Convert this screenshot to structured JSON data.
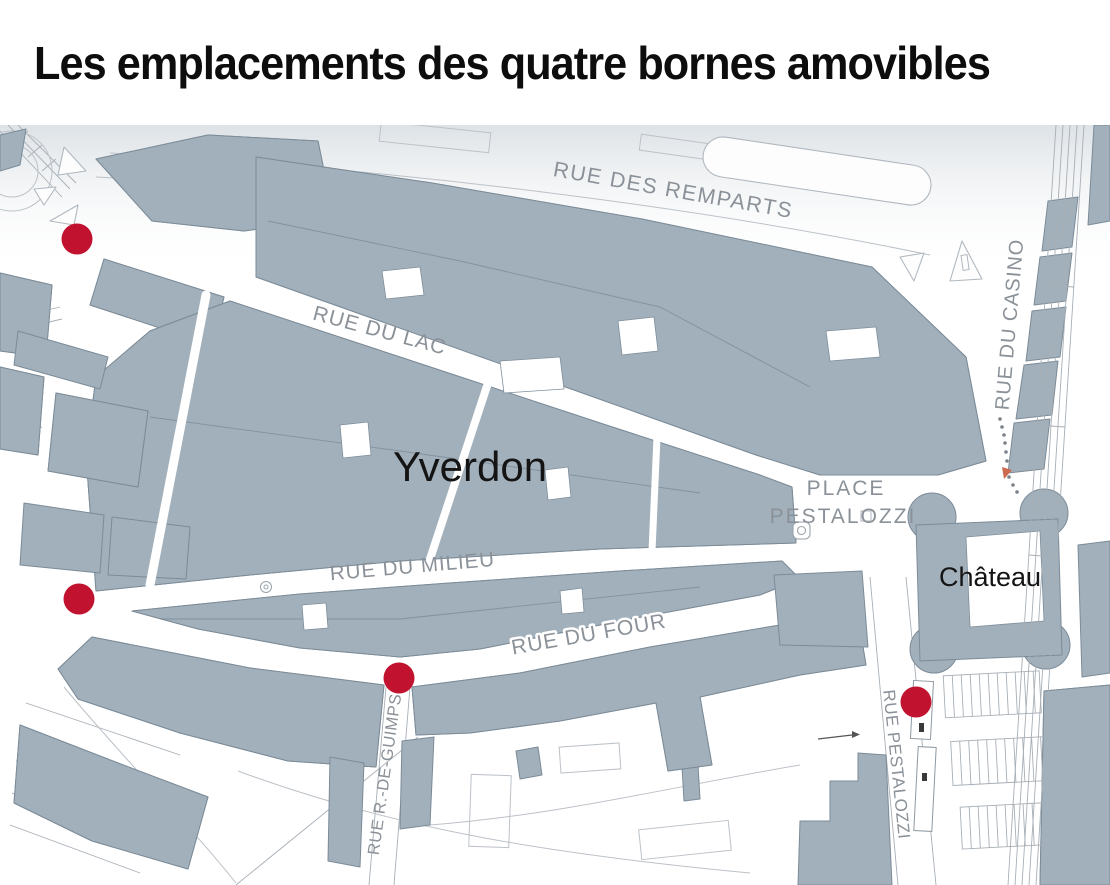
{
  "title": "Les emplacements des quatre bornes amovibles",
  "map": {
    "city": "Yverdon",
    "streets": {
      "remparts": "RUE DES REMPARTS",
      "lac": "RUE DU LAC",
      "milieu": "RUE DU MILIEU",
      "four": "RUE DU FOUR",
      "casino": "RUE DU CASINO",
      "guimps": "RUE R.-DE-GUIMPS",
      "pestalozzi_rue": "RUE PESTALOZZI"
    },
    "places": {
      "place_line1": "PLACE",
      "place_line2": "PESTALOZZI",
      "chateau": "Château"
    },
    "bollards": [
      {
        "id": 1,
        "x": 77,
        "y": 114
      },
      {
        "id": 2,
        "x": 79,
        "y": 474
      },
      {
        "id": 3,
        "x": 399,
        "y": 553
      },
      {
        "id": 4,
        "x": 916,
        "y": 577
      }
    ],
    "colors": {
      "bollard_red": "#c1122f",
      "building_fill": "#a2b0bb",
      "label_gray": "#8a9198"
    }
  }
}
